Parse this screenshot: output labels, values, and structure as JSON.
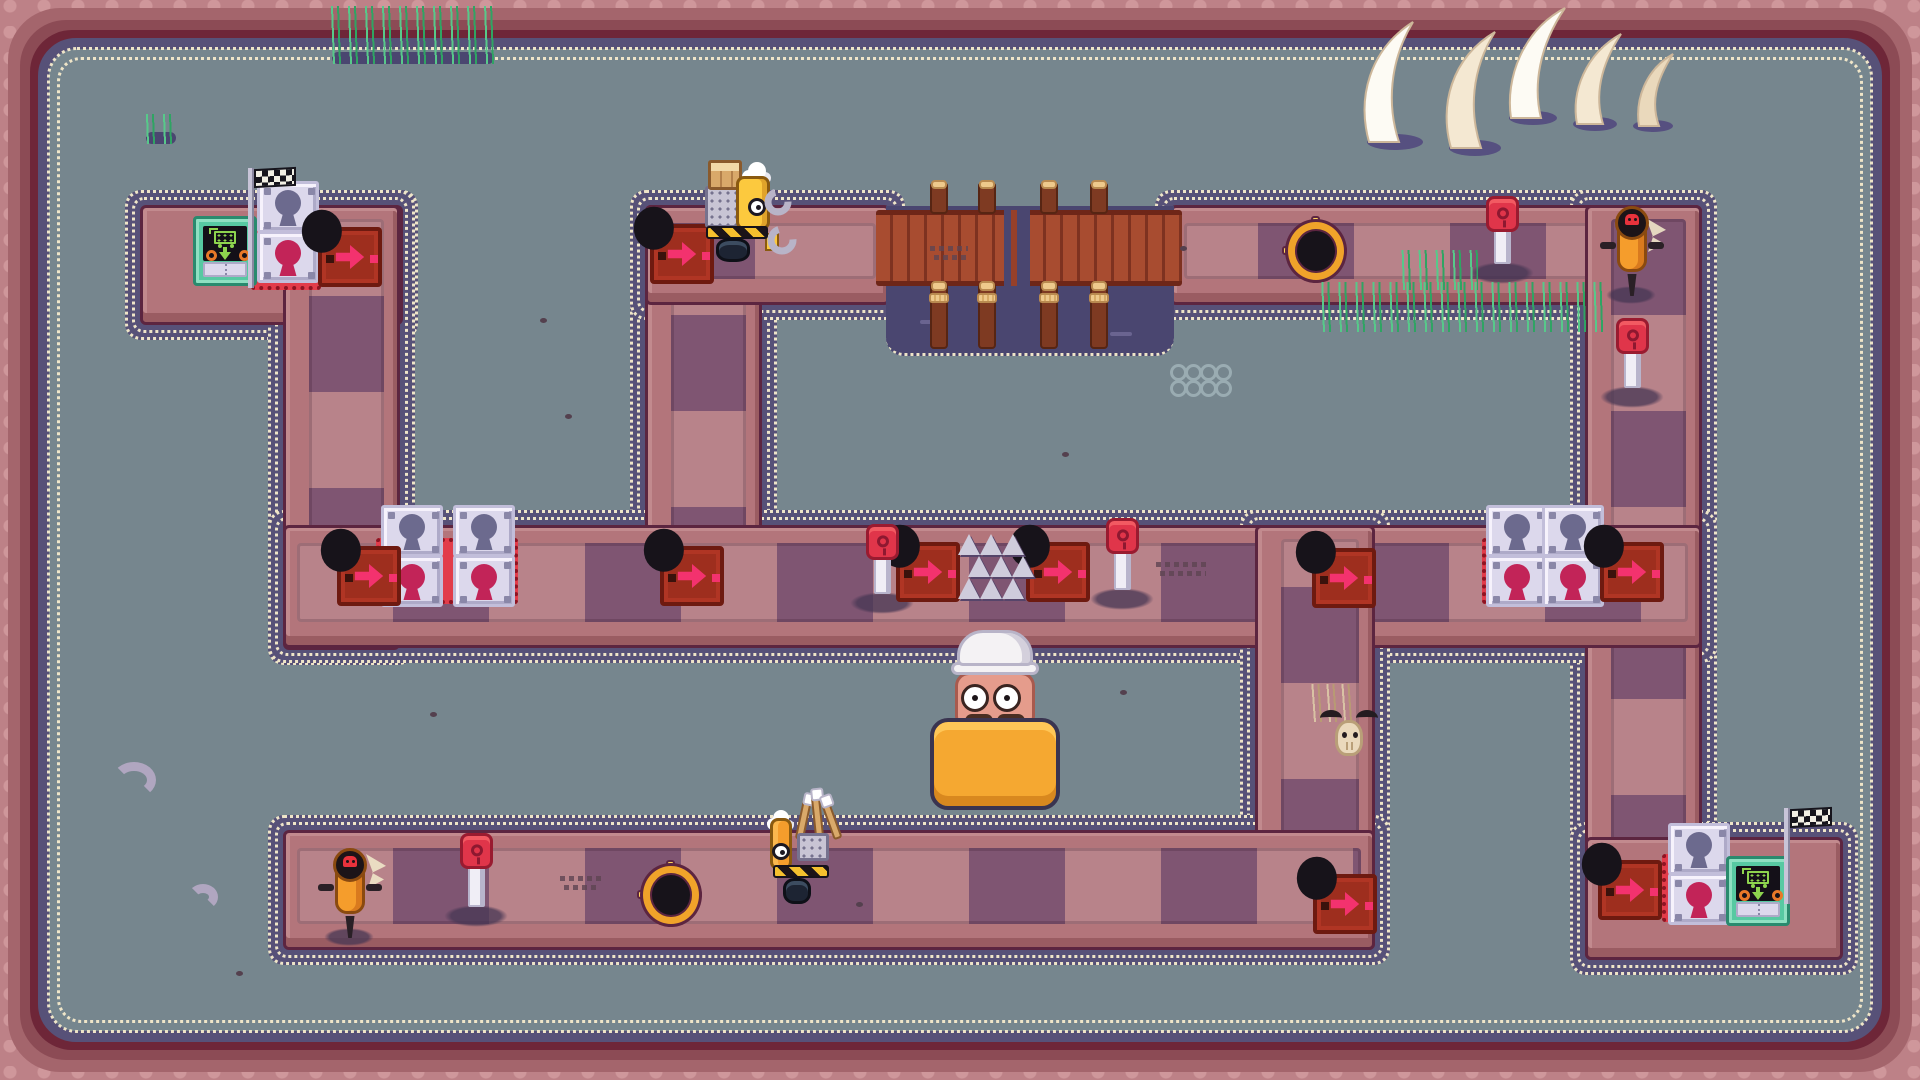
{
  "meta": {
    "app": "pixel-art-puzzle-game-board",
    "canvas": {
      "w": 1920,
      "h": 1080
    }
  },
  "palette": {
    "ground": "#76868e",
    "frame_rose": "#a4656c",
    "frame_dark": "#6e2638",
    "lace_navy": "#575178",
    "lace_cream": "#efe5c8",
    "path_rose": "#b3757b",
    "block_light": "#b8838a",
    "block_dark": "#7f5572",
    "arrow_tile_red": "#9e2e1e",
    "arrow_pink": "#f3326e",
    "arrow_red": "#e8323c",
    "gold_ring": "#f0a32a",
    "lock_tile": "#dcd8ec",
    "keyhole_slate": "#6c6a8e",
    "keyhole_crimson": "#c22458",
    "gate_red": "#e23c4a",
    "goal_teal": "#57c9a2",
    "screen_green": "#8ed44e",
    "button_red": "#e0354a",
    "jackhammer_orange": "#f59d2c",
    "water_navy": "#4a4670",
    "wood": "#a84c30",
    "vehicle_yellow": "#fcc93e",
    "vehicle_orange": "#f59d2c",
    "mat_orange": "#f5a831",
    "grass_green": "#57c98a",
    "tusk_ivory": "#f4e8d2"
  },
  "platforms": [
    {
      "id": "stub-top-left",
      "x": 140,
      "y": 205,
      "w": 263,
      "h": 120,
      "orient": "h",
      "walk": false,
      "phase": "0px"
    },
    {
      "id": "left-vertical",
      "x": 283,
      "y": 205,
      "w": 117,
      "h": 445,
      "orient": "v",
      "walk": true,
      "phase": "-19px"
    },
    {
      "id": "top-mid-vertical",
      "x": 645,
      "y": 205,
      "w": 117,
      "h": 443,
      "orient": "v",
      "walk": true,
      "phase": "0px"
    },
    {
      "id": "top-horizontal-left",
      "x": 645,
      "y": 205,
      "w": 245,
      "h": 100,
      "orient": "h",
      "walk": true,
      "phase": "-96px"
    },
    {
      "id": "top-horizontal-right",
      "x": 1170,
      "y": 205,
      "w": 532,
      "h": 100,
      "orient": "h",
      "walk": true,
      "phase": "-22px"
    },
    {
      "id": "right-vertical",
      "x": 1585,
      "y": 205,
      "w": 117,
      "h": 755,
      "orient": "v",
      "walk": true,
      "phase": "-96px"
    },
    {
      "id": "middle-horizontal",
      "x": 283,
      "y": 525,
      "w": 1419,
      "h": 123,
      "orient": "h",
      "walk": true,
      "phase": "0px"
    },
    {
      "id": "inner-right-vertical",
      "x": 1255,
      "y": 525,
      "w": 120,
      "h": 425,
      "orient": "v",
      "walk": true,
      "phase": "-48px"
    },
    {
      "id": "bottom-horizontal",
      "x": 283,
      "y": 830,
      "w": 1092,
      "h": 120,
      "orient": "h",
      "walk": true,
      "phase": "0px"
    },
    {
      "id": "stub-bottom-right",
      "x": 1585,
      "y": 837,
      "w": 258,
      "h": 123,
      "orient": "h",
      "walk": false,
      "phase": "0px"
    }
  ],
  "water_pit": {
    "x": 886,
    "y": 206,
    "w": 288,
    "h": 150,
    "waves": [
      {
        "x": 920,
        "y": 320,
        "w": 26
      },
      {
        "x": 1110,
        "y": 332,
        "w": 22
      }
    ]
  },
  "bridge": {
    "deck": {
      "x": 876,
      "y": 210,
      "w": 306,
      "h": 76
    },
    "gap": {
      "x": 1004,
      "y": 210,
      "w": 26,
      "h": 76
    },
    "posts_top": [
      {
        "x": 930,
        "y": 182
      },
      {
        "x": 978,
        "y": 182
      },
      {
        "x": 1040,
        "y": 182
      },
      {
        "x": 1090,
        "y": 182
      }
    ],
    "posts_bottom": [
      {
        "x": 930,
        "y": 283
      },
      {
        "x": 978,
        "y": 283
      },
      {
        "x": 1040,
        "y": 283
      },
      {
        "x": 1090,
        "y": 283
      }
    ]
  },
  "gates": [
    {
      "base": {
        "x": 251,
        "y": 226,
        "w": 70,
        "h": 64
      },
      "locks": [
        {
          "x": 257,
          "y": 181,
          "k": "slate"
        },
        {
          "x": 257,
          "y": 231,
          "k": "crimson"
        }
      ]
    },
    {
      "base": {
        "x": 376,
        "y": 538,
        "w": 142,
        "h": 66
      },
      "locks": [
        {
          "x": 381,
          "y": 505,
          "k": "slate"
        },
        {
          "x": 381,
          "y": 555,
          "k": "crimson"
        },
        {
          "x": 453,
          "y": 505,
          "k": "slate"
        },
        {
          "x": 453,
          "y": 555,
          "k": "crimson"
        }
      ]
    },
    {
      "base": {
        "x": 1482,
        "y": 538,
        "w": 118,
        "h": 66
      },
      "locks": [
        {
          "x": 1486,
          "y": 505,
          "k": "slate"
        },
        {
          "x": 1486,
          "y": 555,
          "k": "crimson"
        },
        {
          "x": 1542,
          "y": 505,
          "k": "slate"
        },
        {
          "x": 1542,
          "y": 555,
          "k": "crimson"
        }
      ]
    },
    {
      "base": {
        "x": 1662,
        "y": 854,
        "w": 68,
        "h": 68
      },
      "locks": [
        {
          "x": 1668,
          "y": 823,
          "k": "slate"
        },
        {
          "x": 1668,
          "y": 873,
          "k": "crimson"
        }
      ]
    }
  ],
  "arrows_red": [
    {
      "x": 318,
      "y": 227
    },
    {
      "x": 650,
      "y": 224
    },
    {
      "x": 337,
      "y": 546
    },
    {
      "x": 660,
      "y": 546
    },
    {
      "x": 896,
      "y": 542
    },
    {
      "x": 1026,
      "y": 542
    },
    {
      "x": 1312,
      "y": 548
    },
    {
      "x": 1600,
      "y": 542
    },
    {
      "x": 1313,
      "y": 874
    },
    {
      "x": 1598,
      "y": 860
    }
  ],
  "arrows_gold": [
    {
      "x": 1288,
      "y": 222
    },
    {
      "x": 643,
      "y": 866
    }
  ],
  "spikes": {
    "x": 958,
    "y": 534,
    "cols": 3,
    "rows": 3,
    "dx": 22,
    "dy": 22,
    "stagger": 10
  },
  "buttons": [
    {
      "x": 1486,
      "y": 196,
      "post_h": 40
    },
    {
      "x": 1616,
      "y": 318,
      "post_h": 42
    },
    {
      "x": 866,
      "y": 524,
      "post_h": 42
    },
    {
      "x": 1106,
      "y": 518,
      "post_h": 44
    },
    {
      "x": 460,
      "y": 833,
      "post_h": 46
    }
  ],
  "jackhammers": [
    {
      "x": 1612,
      "y": 206
    },
    {
      "x": 330,
      "y": 848
    }
  ],
  "goals": [
    {
      "x": 193,
      "y": 216,
      "flag": {
        "pole_x": 248,
        "pole_y": 168,
        "pole_h": 120,
        "cloth_x": 254,
        "cloth_y": 168,
        "cloth_w": 42
      }
    },
    {
      "x": 1726,
      "y": 856,
      "flag": {
        "pole_x": 1784,
        "pole_y": 808,
        "pole_h": 96,
        "cloth_x": 1790,
        "cloth_y": 808,
        "cloth_w": 42
      }
    }
  ],
  "vehicles": [
    {
      "type": "loader-with-crate",
      "x": 700,
      "y": 128,
      "facing": "right"
    },
    {
      "type": "truck-with-pipes",
      "x": 765,
      "y": 790,
      "facing": "left"
    }
  ],
  "player": {
    "x": 925,
    "y": 628
  },
  "decorations": {
    "grass_rows": [
      {
        "x": 328,
        "y": 6,
        "w": 170,
        "h": 58,
        "shadow": true
      },
      {
        "x": 142,
        "y": 114,
        "w": 38,
        "h": 30,
        "shadow": true
      },
      {
        "x": 1318,
        "y": 282,
        "w": 292,
        "h": 50,
        "shadow": false
      },
      {
        "x": 1398,
        "y": 250,
        "w": 80,
        "h": 40,
        "shadow": false
      }
    ],
    "dry_grass": {
      "x": 1310,
      "y": 684,
      "w": 44,
      "h": 38
    },
    "skull": {
      "x": 1324,
      "y": 710
    },
    "rings": {
      "x": 1170,
      "y": 364,
      "count": 8
    },
    "tusks": {
      "x": 1355,
      "y": 6,
      "w": 335,
      "h": 150
    },
    "bones": [
      {
        "x": 112,
        "y": 762
      },
      {
        "x": 188,
        "y": 884
      }
    ],
    "tracks": [
      {
        "x": 1156,
        "y": 562,
        "w": 52
      },
      {
        "x": 560,
        "y": 876,
        "w": 42
      },
      {
        "x": 930,
        "y": 246,
        "w": 38
      }
    ],
    "specks": [
      [
        565,
        414
      ],
      [
        1062,
        452
      ],
      [
        856,
        902
      ],
      [
        236,
        971
      ],
      [
        1120,
        690
      ],
      [
        540,
        318
      ],
      [
        1180,
        246
      ],
      [
        430,
        712
      ]
    ],
    "cracks": [
      {
        "x": 366,
        "y": 854
      },
      {
        "x": 1646,
        "y": 218
      }
    ]
  }
}
